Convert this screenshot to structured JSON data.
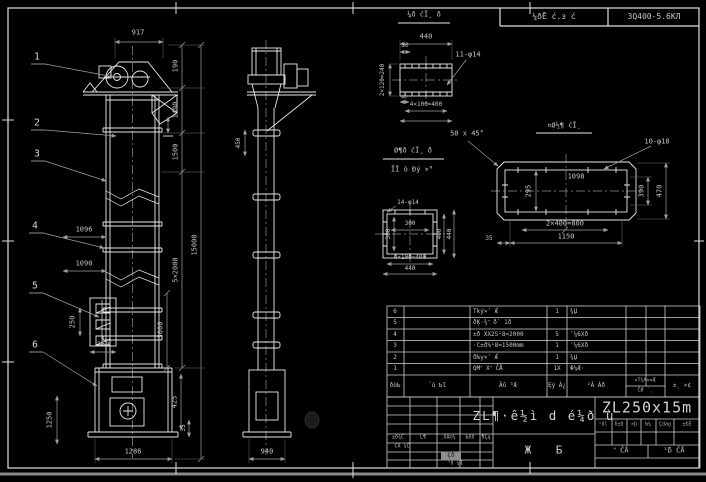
{
  "header": {
    "project_label": "¼ðĒ ć.з ć",
    "drawing_no": "3Q400-5.6ΚЛ"
  },
  "callouts": {
    "c1": "1",
    "c2": "2",
    "c3": "3",
    "c4": "4",
    "c5": "5",
    "c6": "6"
  },
  "front": {
    "w_head": "917",
    "h_top": "190",
    "h_head": "1490",
    "h_upper": "1500",
    "h_total": "15000",
    "h_mid": "5×2000",
    "h_boot_sec": "3000",
    "pitch_a": "1096",
    "pitch_b": "1090",
    "bucket_h": "250",
    "bucket_w": "360",
    "boot_h": "1250",
    "boot_right": "425",
    "boot_small": "35",
    "boot_w": "1286"
  },
  "side": {
    "base_w": "940",
    "col_dim": "450"
  },
  "detail_a": {
    "title": "¼ð ćĪ¸ ð",
    "w": "440",
    "offset": "30",
    "left": "2×120=240",
    "small": "40",
    "spacing": "4×100=400",
    "holes": "11-φ14"
  },
  "detail_b": {
    "title": "¤Ø½¶ ćĪ¸",
    "inner": "1098",
    "height": "295",
    "spacing": "2×400=800",
    "overall": "1150",
    "right_inner": "390",
    "right_outer": "470",
    "left_small": "35",
    "holes": "10-φ18",
    "chamfer": "50 x 45°"
  },
  "detail_c": {
    "label1": "Ø¶ð ćĪ¸ ð",
    "label2": "ĪĪ ò Đý ×°",
    "holes": "14-φ14",
    "inner_w": "300",
    "inner_h": "300",
    "spacing": "4×100=400",
    "w": "440",
    "right_inner": "400",
    "right_outer": "440"
  },
  "bom": {
    "headers": {
      "seq": "ðòƄ",
      "code": "´ú ƄƖ",
      "name": "Ăû ³Æ",
      "qty": "Ęý Á¿",
      "material": "²Ă Áð",
      "weight_top": "¤T¼X¤¤Æ",
      "weight_bottom": "ČØ ´¸",
      "note": "±¸ ×¢"
    },
    "rows": [
      {
        "seq": "6",
        "name": "Tký×ʹ Ǽ",
        "qty": "1",
        "material": "¾Џ"
      },
      {
        "seq": "5",
        "name": "ðĶ·¾ʺ ðʹ 1ð",
        "qty": "",
        "material": ""
      },
      {
        "seq": "4",
        "name": "±ð XX25¹8=2000",
        "qty": "5",
        "material": "ʾ¼6Χð"
      },
      {
        "seq": "3",
        "name": "·C±ð%¹8=1500mm",
        "qty": "1",
        "material": "ʾ¼6Χð"
      },
      {
        "seq": "2",
        "name": "ðƕy×ʹ Ǽ",
        "qty": "1",
        "material": "¾Џ"
      },
      {
        "seq": "1",
        "name": "QMʺ Xʺ ČÅ",
        "qty": "1X",
        "material": "Φ¼Æ·"
      }
    ]
  },
  "title_block": {
    "rev_headers": [
      "±ð¾Č",
      "Ĺ¶",
      "¸ðÄ©¼",
      "ƄXð",
      "¶Çą"
    ],
    "rev_label": "ĆÅ ¾Č",
    "rev_badge": "Çð",
    "rev_sub": "¹ð ¼Æ",
    "title": "ZL¶·ê½ì d é¼ð ù",
    "subtitle": "Ж Б",
    "model": "ZL250x15m",
    "sig_headers": [
      "¹ðl",
      "ĥ±ð",
      "×þ",
      "Ƅ¼",
      "Çdag",
      "±ƅƗ"
    ],
    "check_left": "ʺ ČÅ",
    "check_right": "¹ƃ ČÅ"
  }
}
